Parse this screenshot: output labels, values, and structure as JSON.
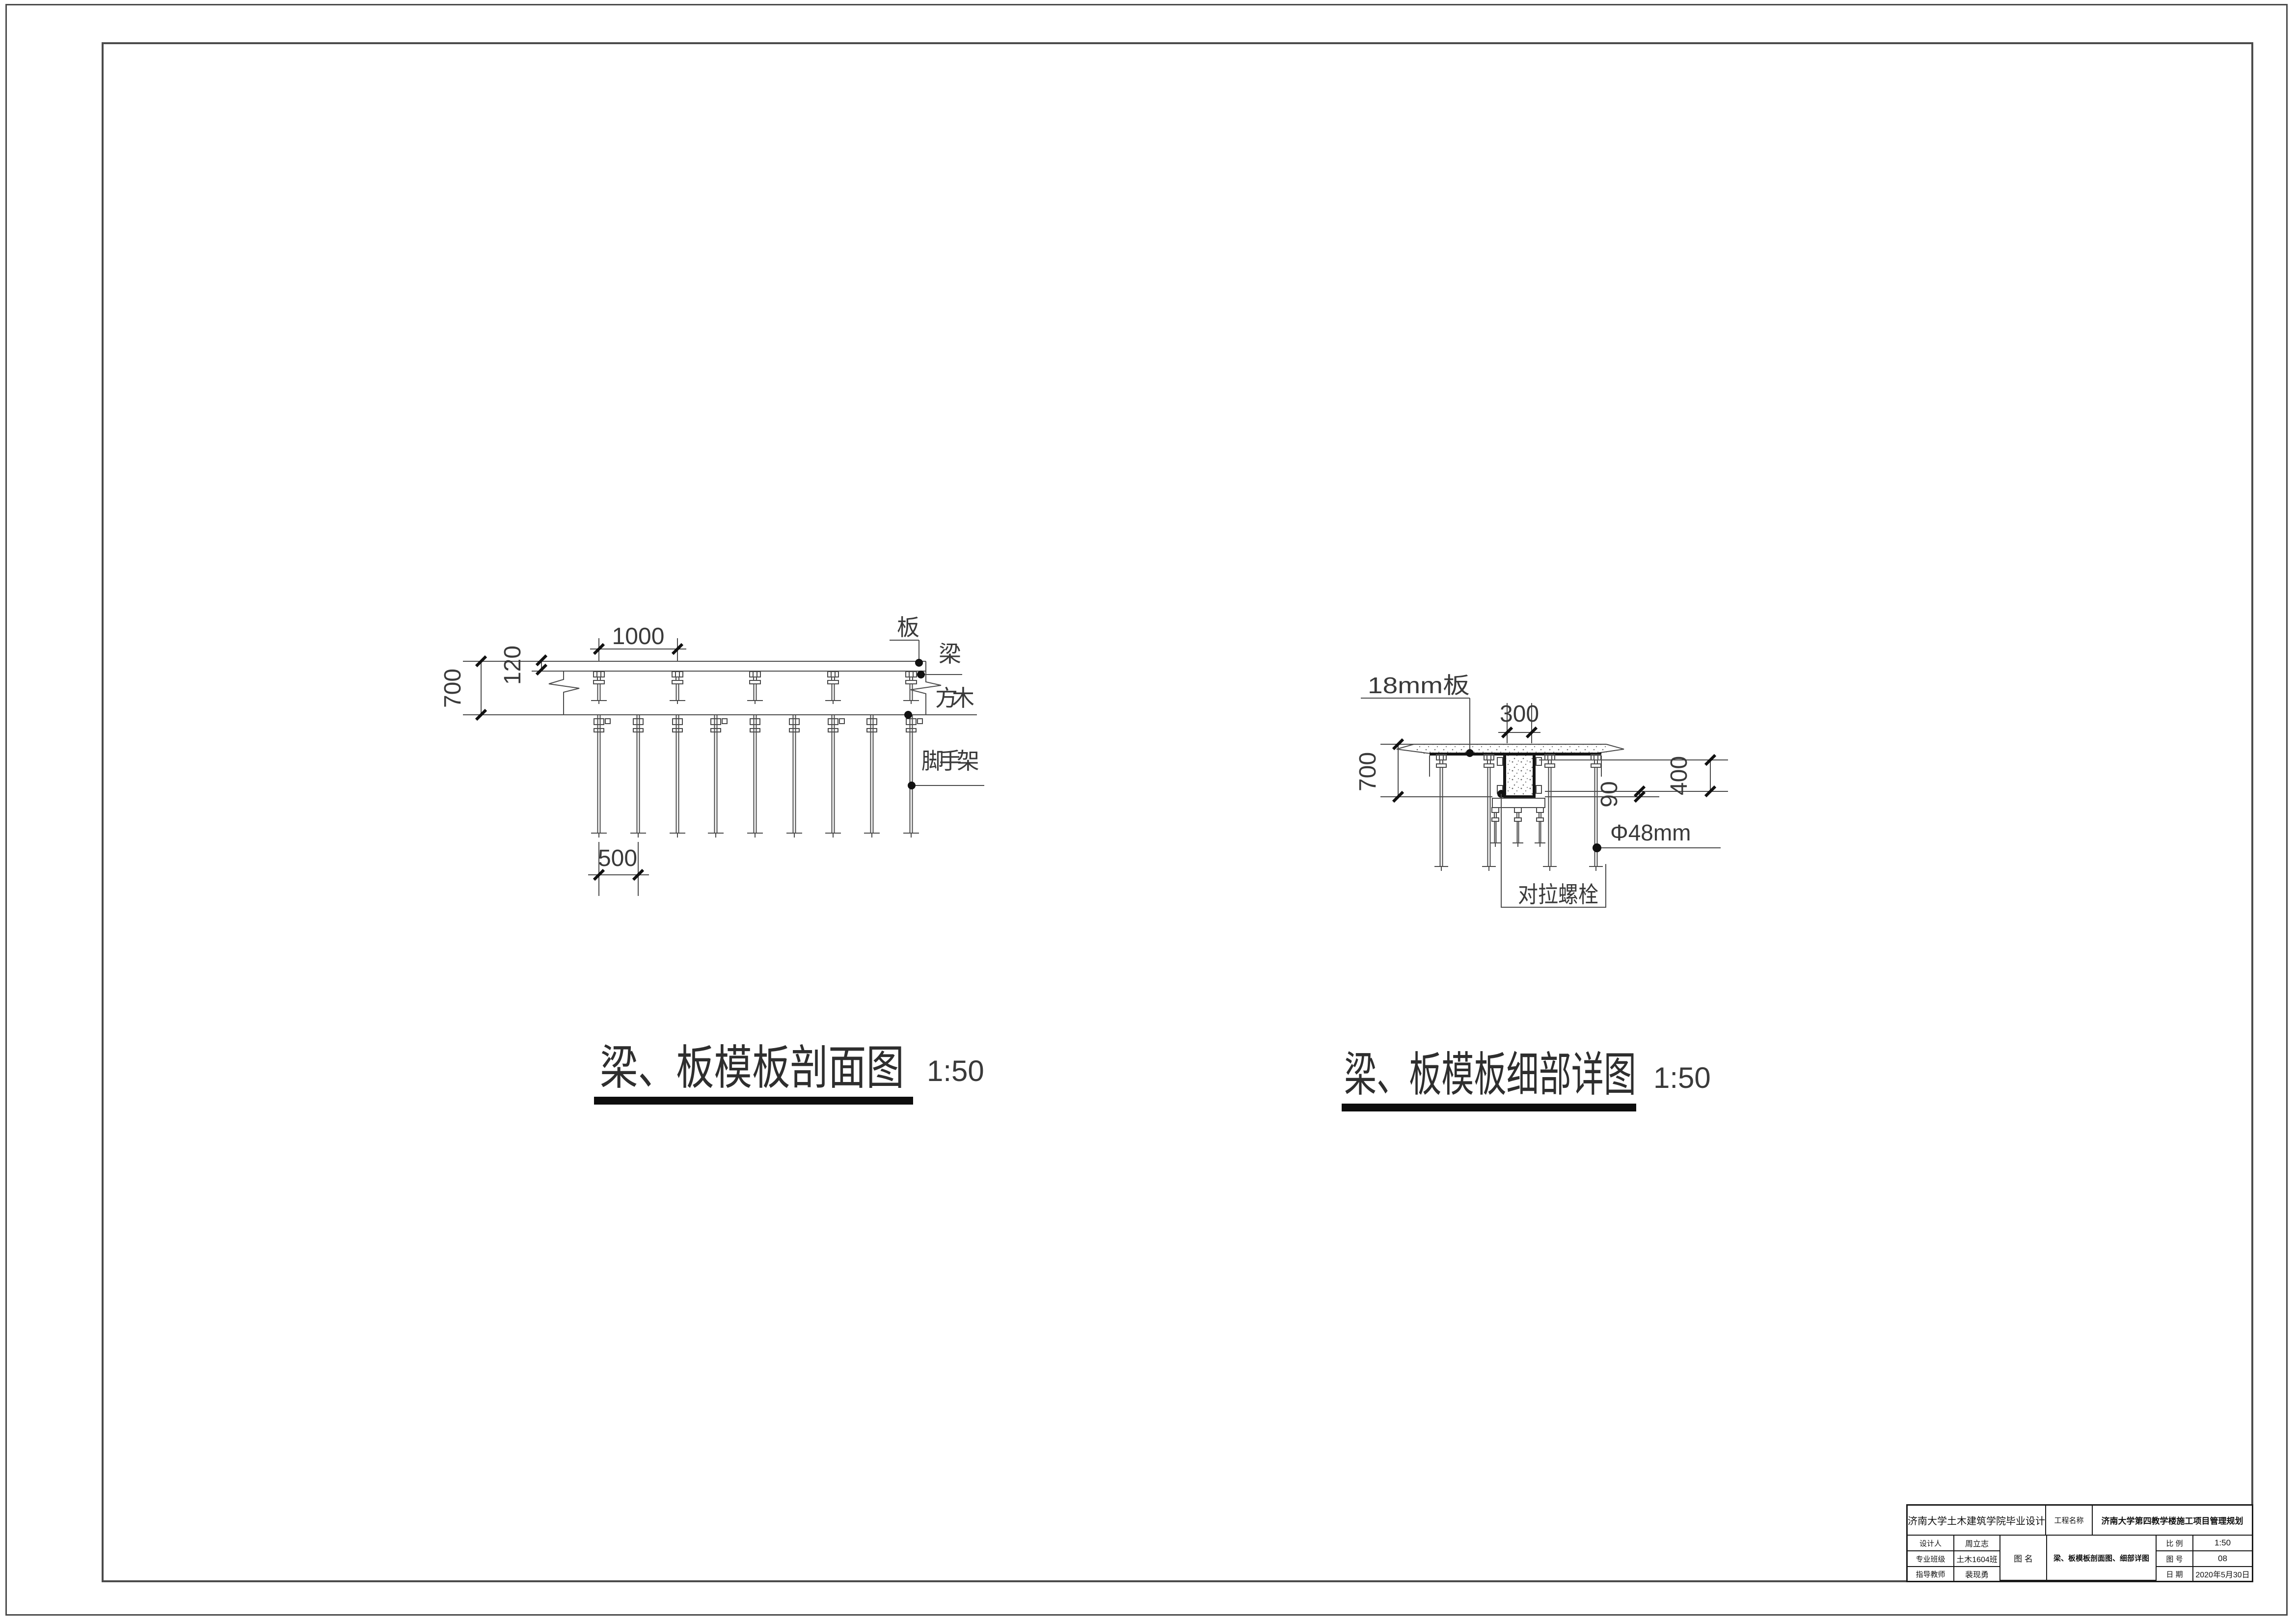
{
  "colors": {
    "line": "#4a4a4a",
    "dark": "#111111",
    "background": "#ffffff"
  },
  "section_drawing": {
    "title": "梁、板模板剖面图",
    "scale": "1:50",
    "dim_spacing_top": "1000",
    "dim_slab_thickness": "120",
    "dim_beam_height": "700",
    "dim_post_spacing": "500",
    "label_slab": "板",
    "label_beam": "梁",
    "label_timber": "方木",
    "label_scaffold": "脚手架"
  },
  "detail_drawing": {
    "title": "梁、板模板细部详图",
    "scale": "1:50",
    "label_plywood": "18mm板",
    "dim_beam_width": "300",
    "dim_beam_height": "700",
    "dim_right": "400",
    "dim_clamp": "90",
    "label_pipe": "Φ48mm",
    "label_tie_bolt": "对拉螺栓"
  },
  "title_block": {
    "school": "济南大学土木建筑学院毕业设计",
    "project_label": "工程名称",
    "project_name": "济南大学第四教学楼施工项目管理规划",
    "designer_label": "设计人",
    "designer": "周立志",
    "class_label": "专业班级",
    "class_value": "土木1604班",
    "advisor_label": "指导教师",
    "advisor": "裴现勇",
    "drawing_label": "图 名",
    "drawing_name": "梁、板模板剖面图、细部详图",
    "scale_label": "比 例",
    "scale_value": "1:50",
    "no_label": "图 号",
    "no_value": "08",
    "date_label": "日 期",
    "date_value": "2020年5月30日"
  }
}
